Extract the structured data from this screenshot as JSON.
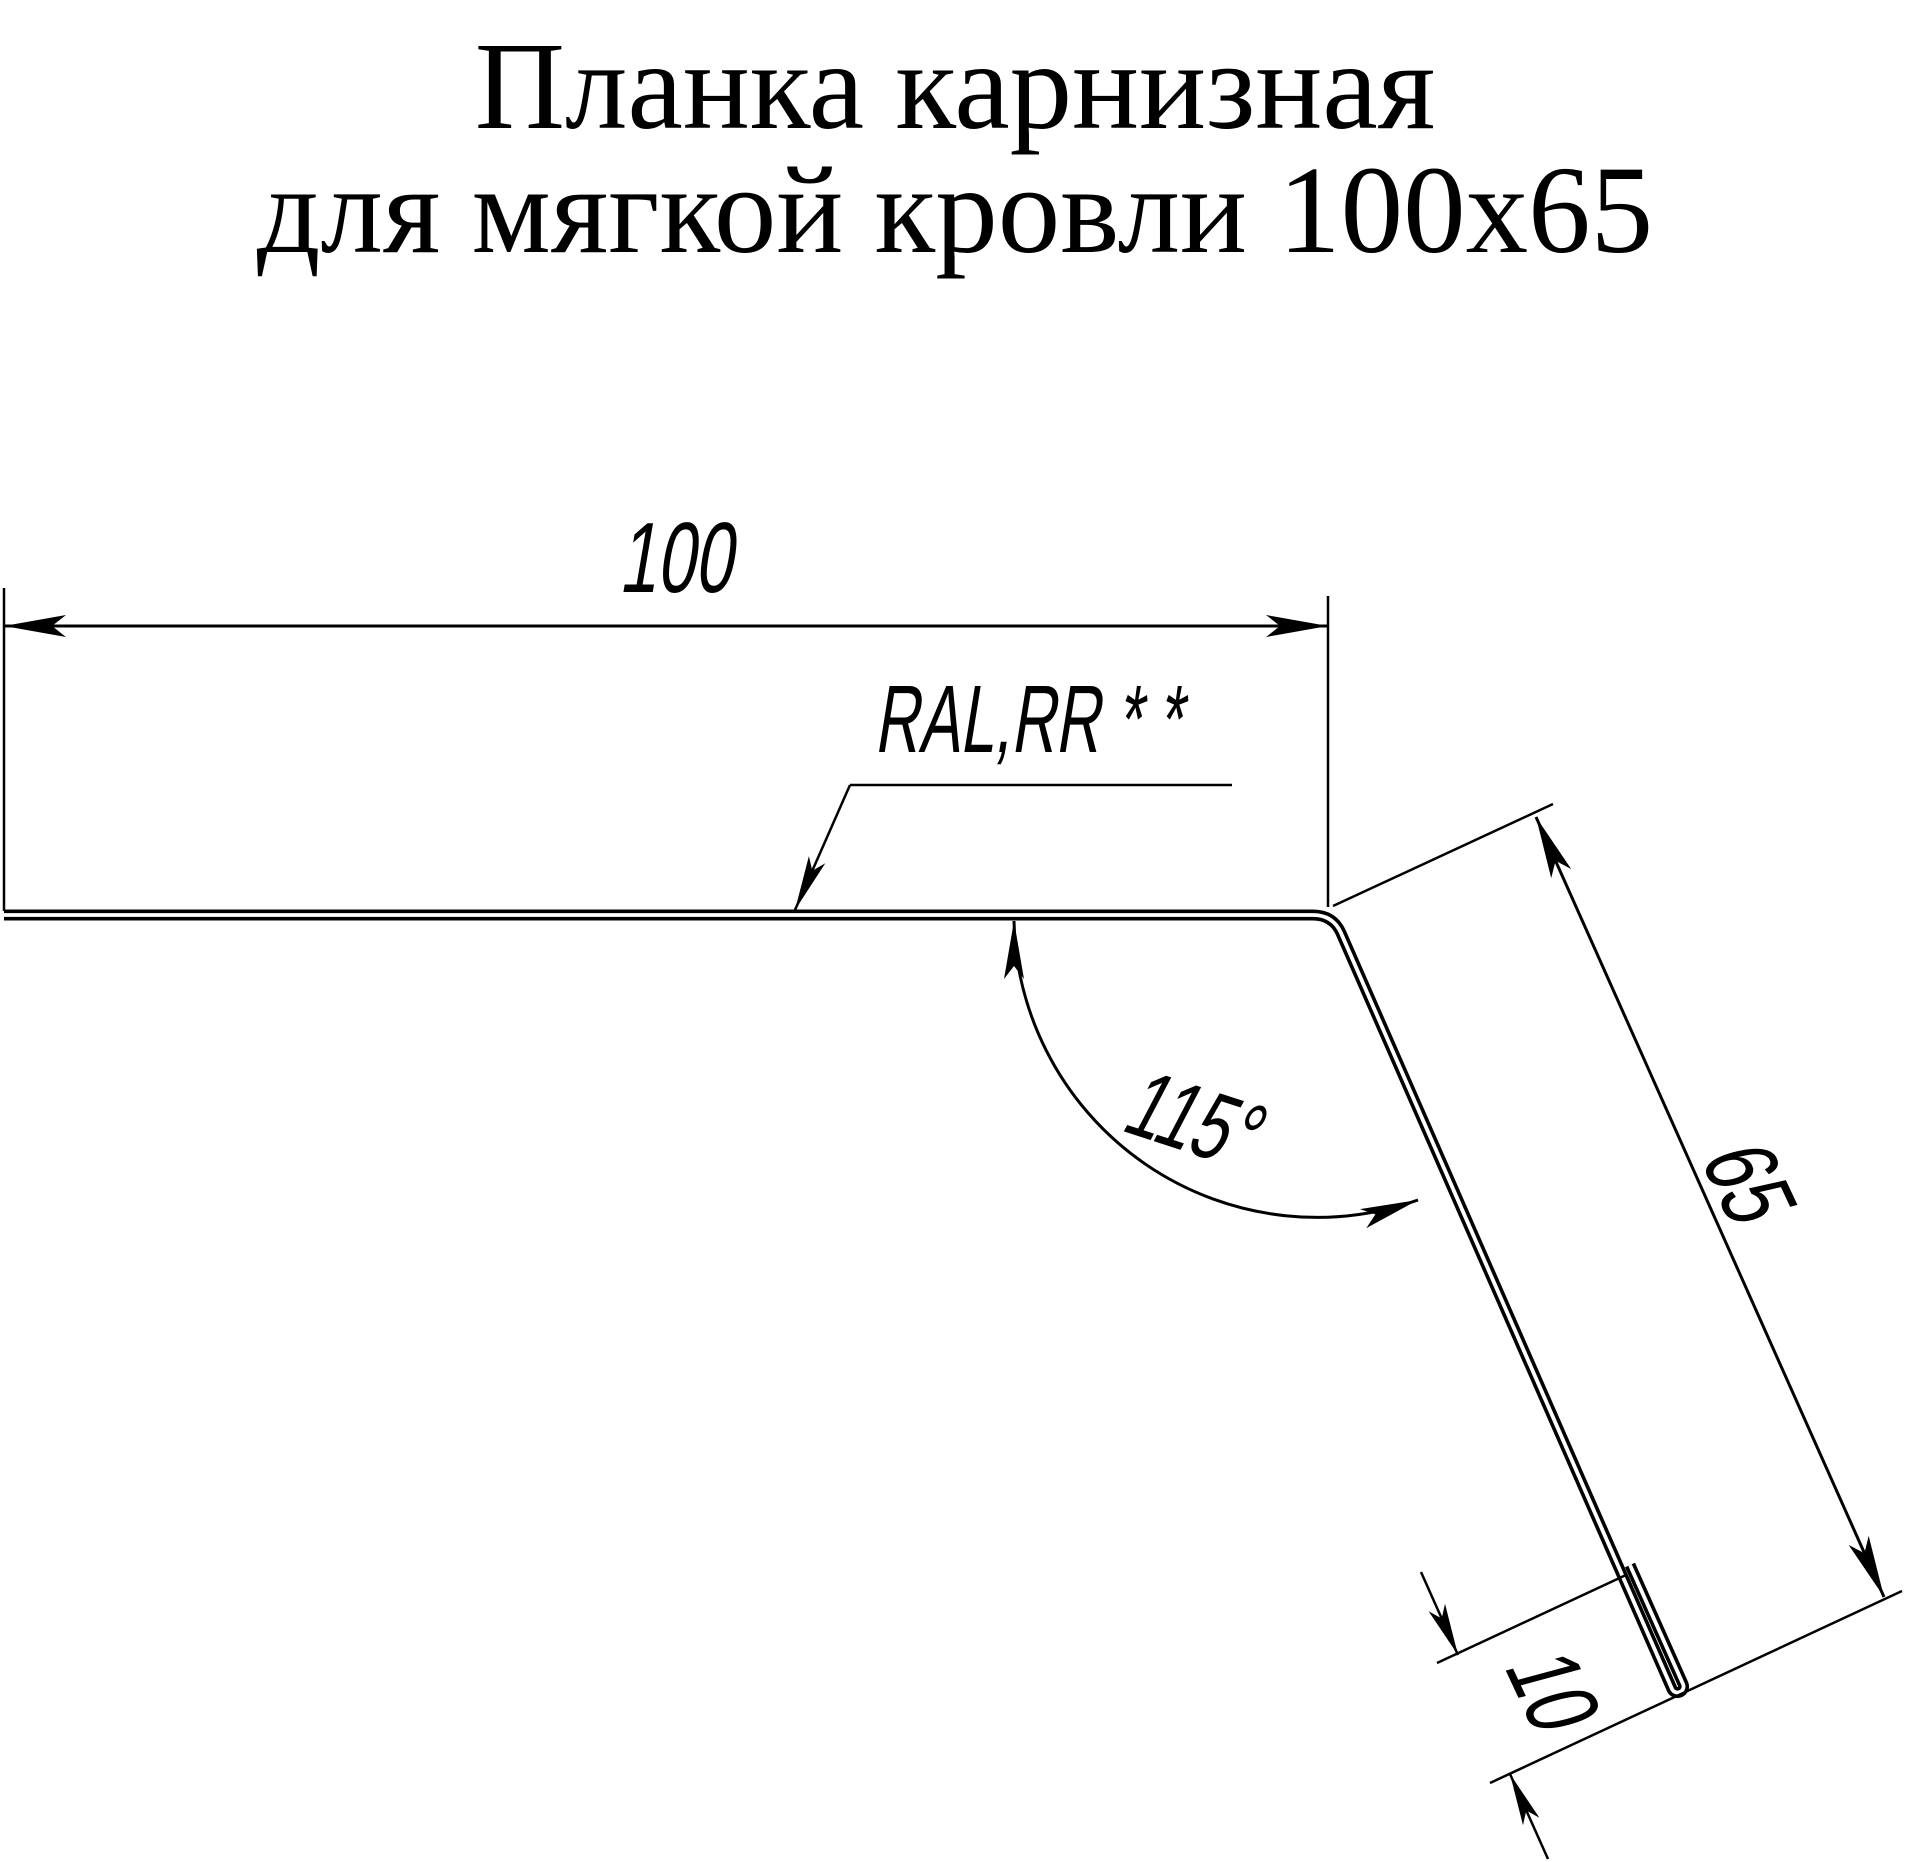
{
  "title": {
    "line1": "Планка карнизная",
    "line2": "для мягкой кровли 100x65"
  },
  "dimensions": {
    "top_width": "100",
    "leg_height": "65",
    "hem": "10",
    "bend_angle": "115°",
    "coating_note": "RAL,RR * *"
  },
  "colors": {
    "ink": "#000000",
    "paper": "#ffffff"
  }
}
